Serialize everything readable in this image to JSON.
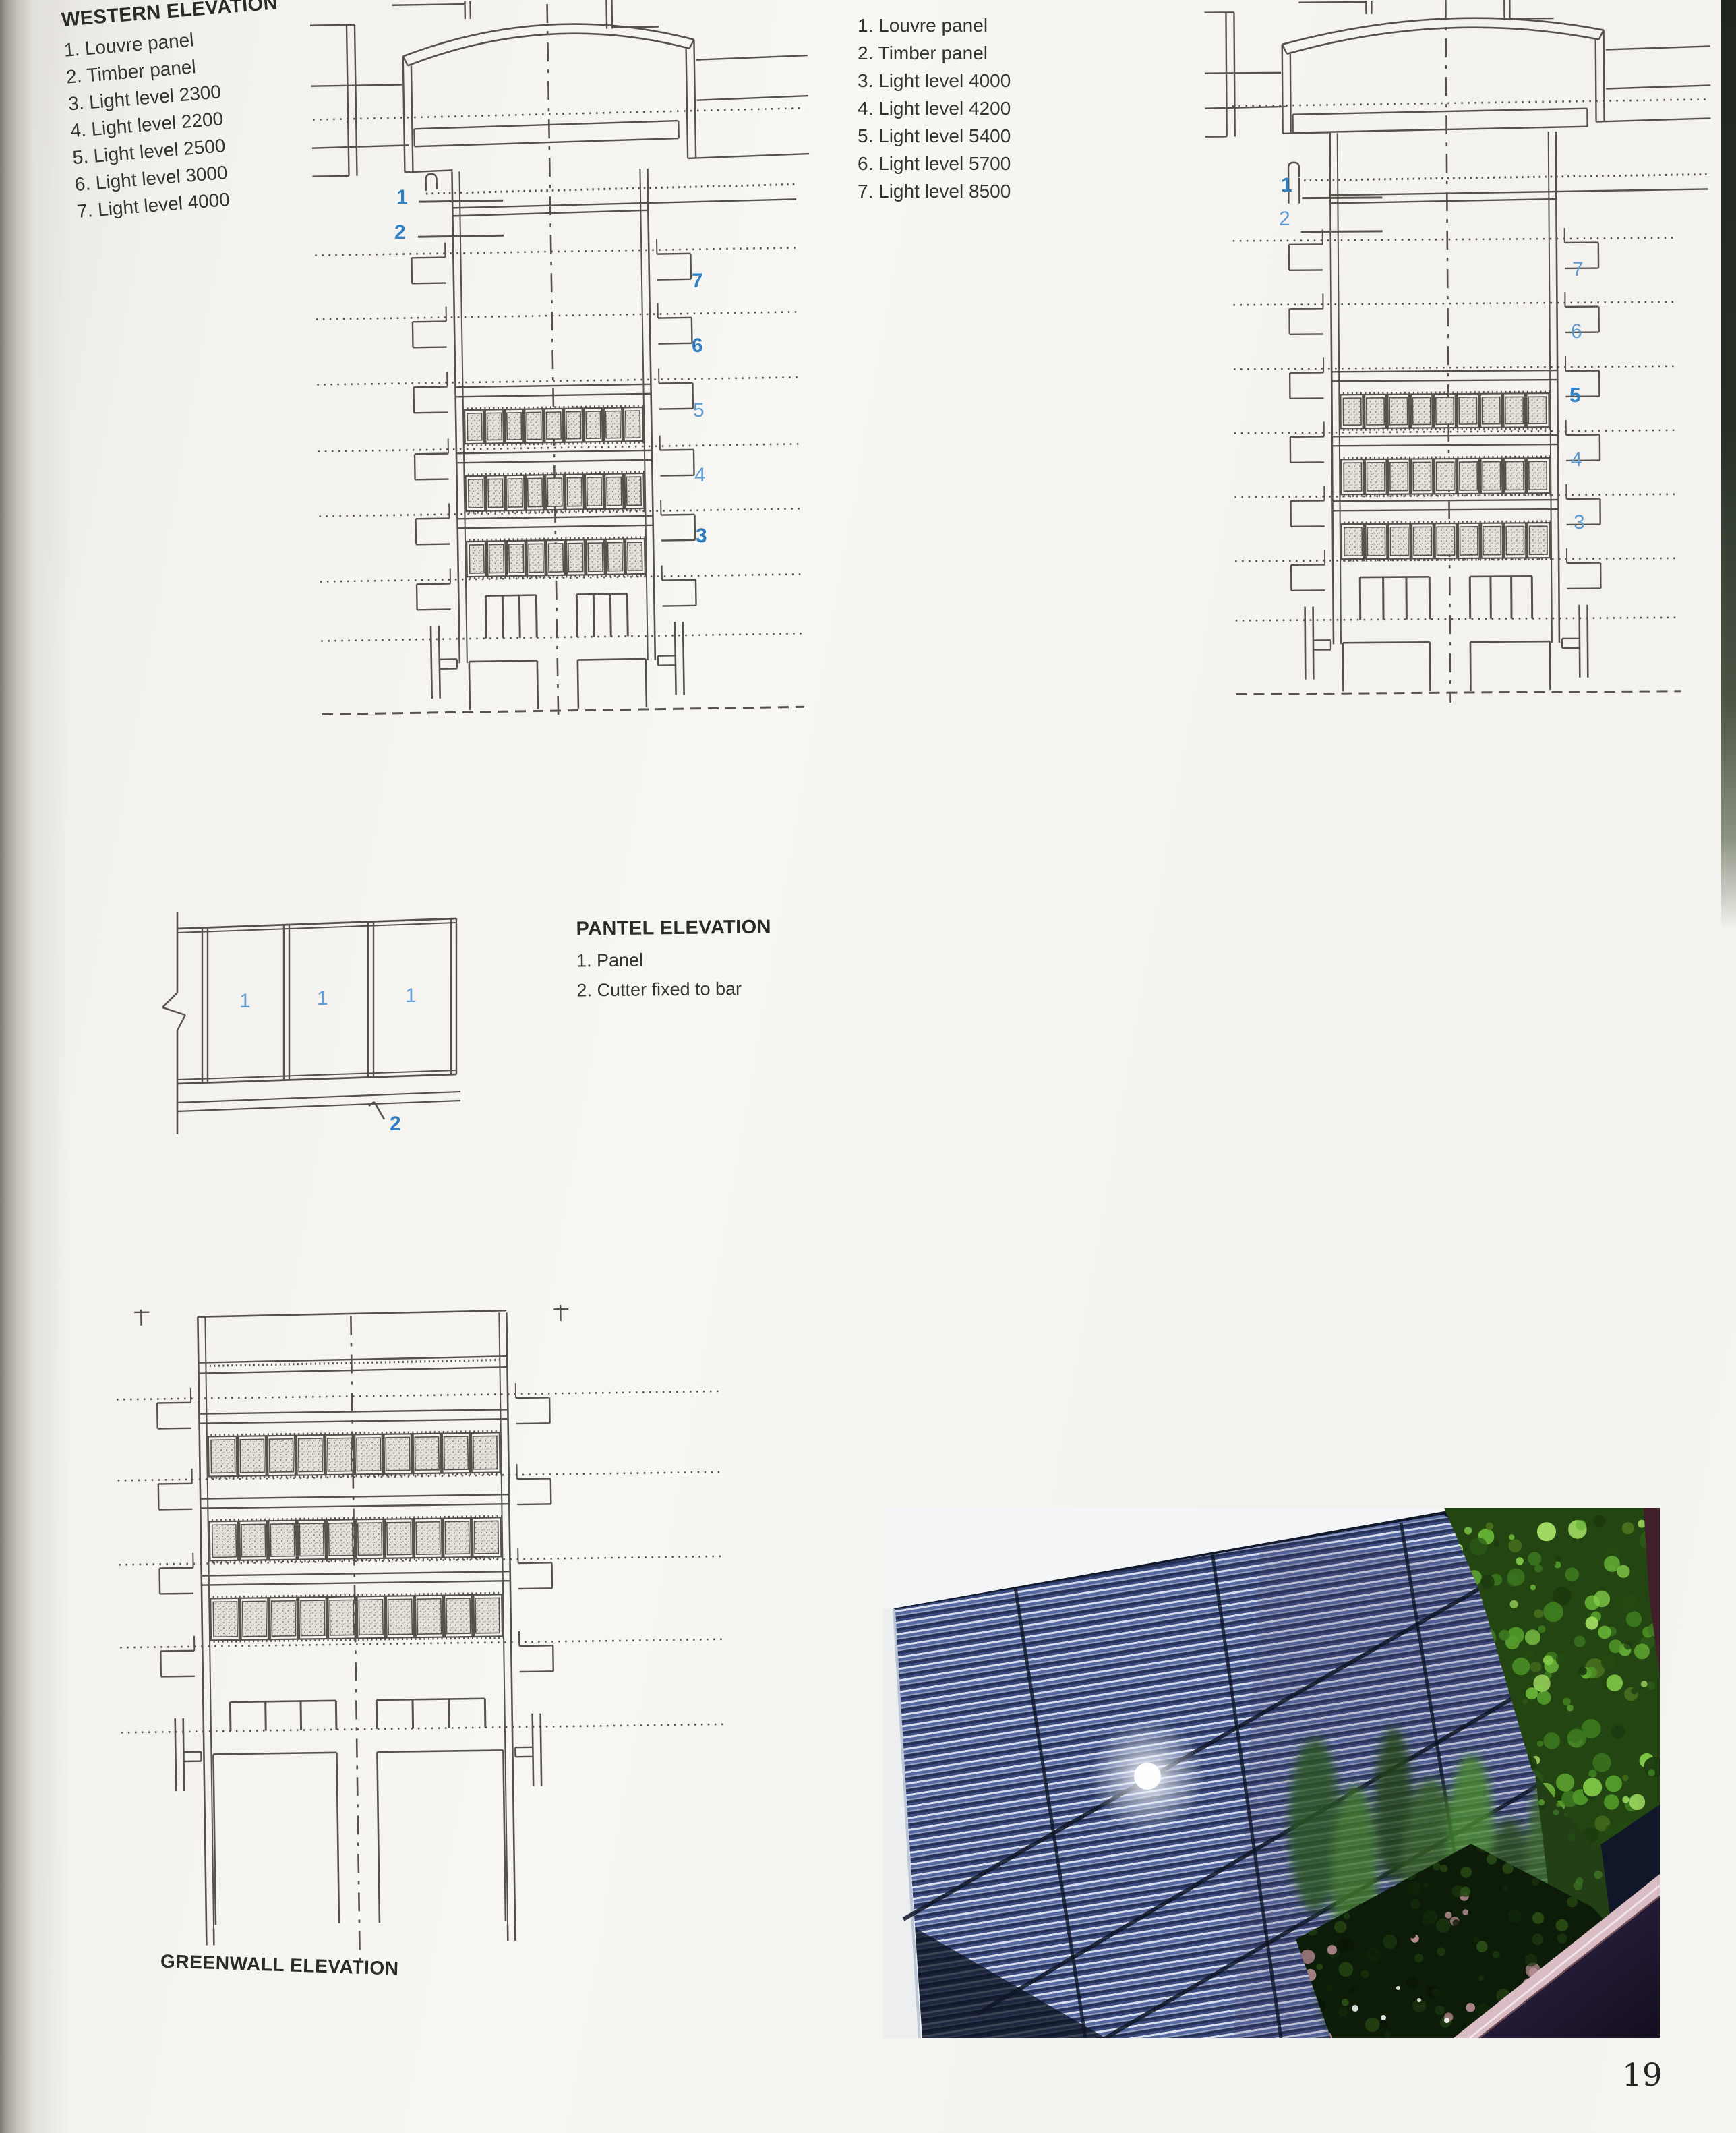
{
  "page": {
    "number": "19"
  },
  "colors": {
    "callout_blue": "#2f7fc4",
    "callout_blue_light": "#5e9bd2",
    "line_gray": "#55524b",
    "paper": "#f3f1ed"
  },
  "legends": {
    "western": {
      "title": "WESTERN ELEVATION",
      "items": [
        "1. Louvre panel",
        "2. Timber panel",
        "3. Light level 2300",
        "4. Light level 2200",
        "5. Light level 2500",
        "6. Light level 3000",
        "7. Light level 4000"
      ]
    },
    "eastern": {
      "title": "EASTERN ELEVATION",
      "items": [
        "1. Louvre panel",
        "2. Timber panel",
        "3. Light level 4000",
        "4. Light level 4200",
        "5. Light level 5400",
        "6. Light level 5700",
        "7. Light level 8500"
      ]
    },
    "pantel": {
      "title": "PANTEL ELEVATION",
      "items": [
        "1. Panel",
        "2. Cutter fixed to bar"
      ]
    },
    "greenwall": {
      "title": "GREENWALL ELEVATION"
    }
  },
  "callouts": {
    "western": {
      "left": [
        "1",
        "2"
      ],
      "right": [
        "7",
        "6",
        "5",
        "4",
        "3"
      ]
    },
    "eastern": {
      "left": [
        "1",
        "2"
      ],
      "right": [
        "7",
        "6",
        "5",
        "4",
        "3"
      ]
    },
    "pantel": {
      "panel_labels": [
        "1",
        "1",
        "1"
      ],
      "bar_label": "2"
    }
  }
}
